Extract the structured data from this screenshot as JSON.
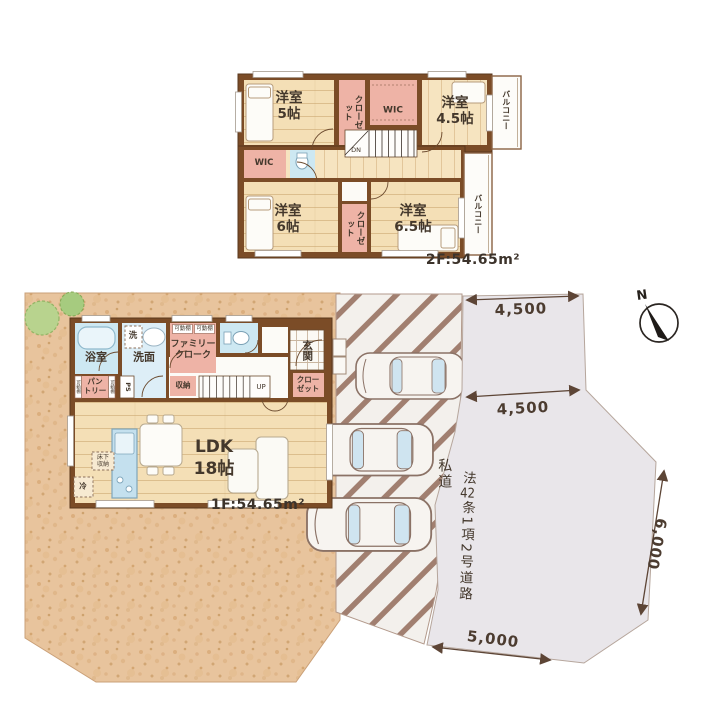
{
  "floor2f": {
    "area_label": "2F:54.65m²",
    "rooms": {
      "yoshitsu5": "洋室\n5帖",
      "closet_top": "クローゼット",
      "wic_top": "WIC",
      "yoshitsu45": "洋室\n4.5帖",
      "balcony_top": "バルコニー",
      "stairs_dn": "DN",
      "wic_left": "WIC",
      "yoshitsu6": "洋室\n6帖",
      "closet_bottom": "クローゼット",
      "yoshitsu65": "洋室\n6.5帖",
      "balcony_right": "バルコニー"
    }
  },
  "floor1f": {
    "area_label": "1F:54.65m²",
    "rooms": {
      "bath": "浴室",
      "washer": "洗",
      "washroom": "洗面",
      "family_cloak": "ファミリー\nクローク",
      "movable_shelf": "可動棚",
      "entrance": "玄関",
      "closet": "クロー\nゼット",
      "stairs_up": "UP",
      "storage": "収納",
      "pantry": "パン\nトリー",
      "pipe_space": "PS",
      "ldk": "LDK",
      "ldk_size": "18帖",
      "underfloor_storage": "床下\n収納",
      "fridge": "冷"
    }
  },
  "site": {
    "north_label": "N",
    "dimensions": {
      "top": "4,500",
      "middle": "4,500",
      "right": "6,000",
      "bottom": "5,000"
    },
    "road": {
      "private": "私道",
      "law_prefix": "法",
      "law_number": "42",
      "law_suffix": "条1項2号道路"
    }
  },
  "colors": {
    "wall": "#7b4c27",
    "wood_floor": "#f4dfb6",
    "pink_room": "#eeb3a6",
    "blue_room": "#cde8f2",
    "sand": "#e8c49d",
    "road": "#e9e6ea",
    "line": "#5d4536"
  }
}
